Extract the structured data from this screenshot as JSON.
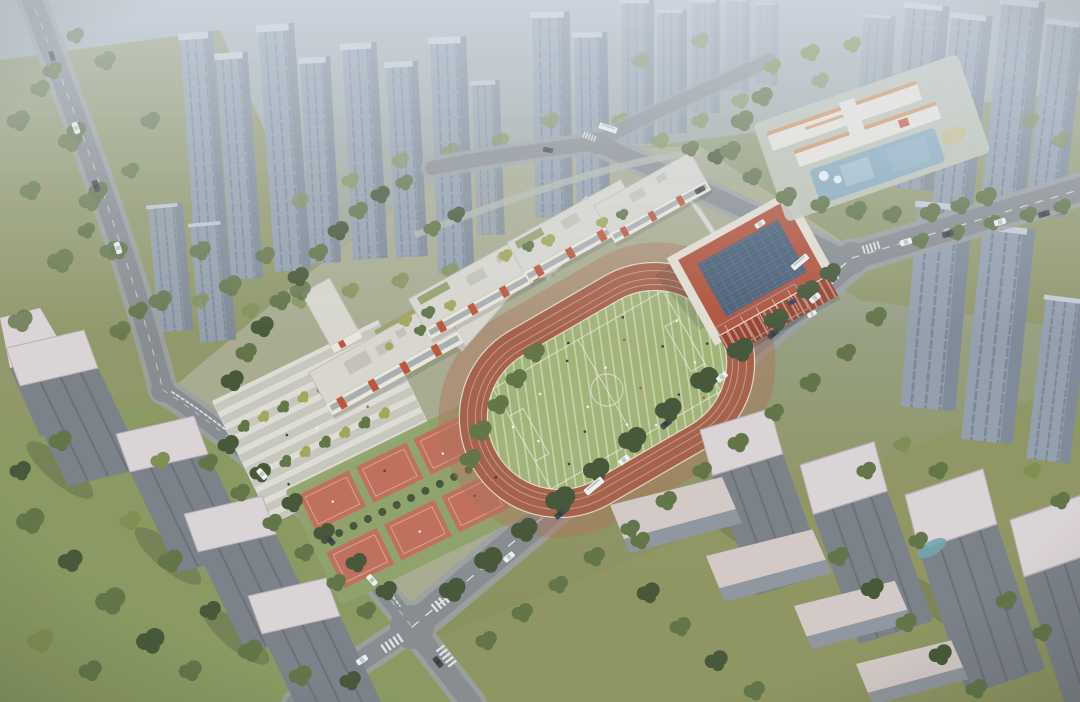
{
  "scene": {
    "description": "Aerial architectural rendering of a school campus: white classroom building slabs with red-orange accents around green courtyards, a terracotta gymnasium with a blue solar-panel roof, an oval running track with a striped green infield, red sports courts, and a striped entry plaza. The campus is bordered by tree-lined roads with cars and buses, a kindergarten with a blue playground at the upper right, olive lawns, and rows of gray high-rise residential towers fading into haze at the horizon.",
    "elements": {
      "school_campus": "school campus grounds",
      "classroom_buildings": "classroom building slabs with courtyards",
      "gymnasium": "gymnasium with rooftop solar panels",
      "running_track": "oval running track with striped infield soccer pitch",
      "sports_courts": "red sports courts with hedge path",
      "entry_plaza": "striped entry plaza with tree rows",
      "kindergarten": "kindergarten with blue playground and sand pit",
      "residential_towers_near": "gray residential towers with light rooftops",
      "residential_towers_far": "hazy distant high-rise towers",
      "low_rise_slabs": "low-rise residential slab buildings",
      "roads": "roads with lane markings, crosswalks and traffic",
      "greenery": "street trees, hedges and lawns",
      "pond": "small courtyard pond"
    }
  },
  "colors": {
    "bg_top": "#aab4bd",
    "bg_mid": "#9aa38e",
    "bg_low": "#8d935f",
    "bg_bot": "#848b52",
    "ground_olive": "#8d935c",
    "lawn_green": "#87975a",
    "campus_base": "#a8ab8c",
    "road": "#85898d",
    "road_light": "#9ba0a3",
    "marking": "#eceeee",
    "tree_dark": "#3f512f",
    "tree_mid": "#5d7040",
    "tree_light": "#7c8c4a",
    "tree_yellow": "#a3a455",
    "tower_far_face": "#929eac",
    "tower_far_side": "#7b8795",
    "tower_far_top": "#c6cdd6",
    "tower_near_face": "#787d85",
    "tower_near_side": "#5f646b",
    "tower_near_top": "#ded5d8",
    "slab_roof": "#d6cbc7",
    "slab_side": "#8f949c",
    "school_roof": "#dbd8cf",
    "school_roof_edge": "#c2bfb4",
    "school_roof_unit": "#c5c2b8",
    "school_wall": "#efe9dc",
    "school_accent": "#bd4f33",
    "school_glass": "#9aa3a8",
    "courtyard": "#98a165",
    "gym_wall": "#b04c34",
    "gym_wall_dark": "#8f3d2b",
    "gym_roof": "#41566e",
    "gym_trim": "#e6dfd2",
    "track": "#a55b41",
    "track_apron": "#ad6d52",
    "infield": "#a2b373",
    "line_white": "#f2f3ea",
    "court_red": "#c06b55",
    "court_green": "#8da064",
    "plaza": "#c9c7bd",
    "plaza_stripe": "#e4e2da",
    "kinder_white": "#ece7dd",
    "kinder_orange": "#d28a4e",
    "kinder_blue": "#87a9bd",
    "kinder_sand": "#c9bc8b",
    "pond": "#6fa3ad",
    "car_white": "#f2f4f4",
    "car_dark": "#3c4248",
    "shadow": "#2e3526"
  }
}
